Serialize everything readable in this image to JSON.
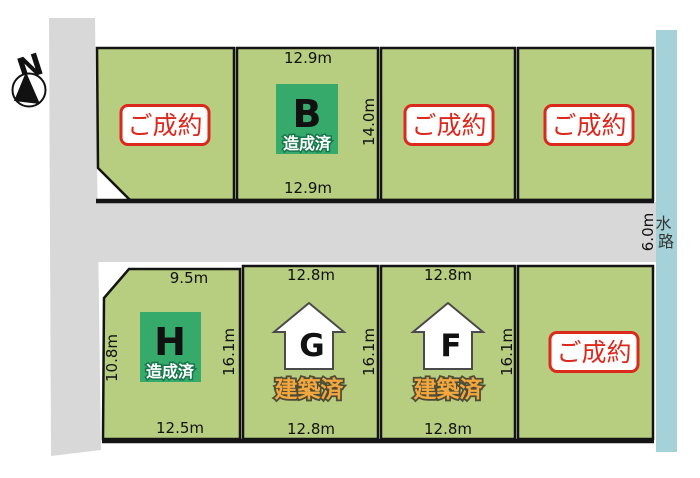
{
  "compass": {
    "label": "N"
  },
  "waterway": {
    "label": "水路",
    "width_label": "6.0m"
  },
  "legend": {
    "sold": "ご成約",
    "graded": "造成済",
    "built": "建築済"
  },
  "colors": {
    "lot_green": "#b7cd7f",
    "road_gray": "#d8d8d8",
    "waterway_blue": "#a5d2d8",
    "sold_red": "#dc291e",
    "graded_green": "#35aa6b",
    "built_orange": "#f4a73c"
  },
  "lots": [
    {
      "id": "top-1",
      "status_label": "ご成約"
    },
    {
      "id": "B",
      "letter": "B",
      "status_label": "造成済",
      "dim_top": "12.9m",
      "dim_right": "14.0m",
      "dim_bottom": "12.9m"
    },
    {
      "id": "top-3",
      "status_label": "ご成約"
    },
    {
      "id": "top-4",
      "status_label": "ご成約"
    },
    {
      "id": "H",
      "letter": "H",
      "status_label": "造成済",
      "dim_top": "9.5m",
      "dim_left": "10.8m",
      "dim_right": "16.1m",
      "dim_bottom": "12.5m"
    },
    {
      "id": "G",
      "letter": "G",
      "status_label": "建築済",
      "dim_top": "12.8m",
      "dim_right": "16.1m",
      "dim_bottom": "12.8m"
    },
    {
      "id": "F",
      "letter": "F",
      "status_label": "建築済",
      "dim_top": "12.8m",
      "dim_right": "16.1m",
      "dim_bottom": "12.8m"
    },
    {
      "id": "bottom-4",
      "status_label": "ご成約"
    }
  ]
}
